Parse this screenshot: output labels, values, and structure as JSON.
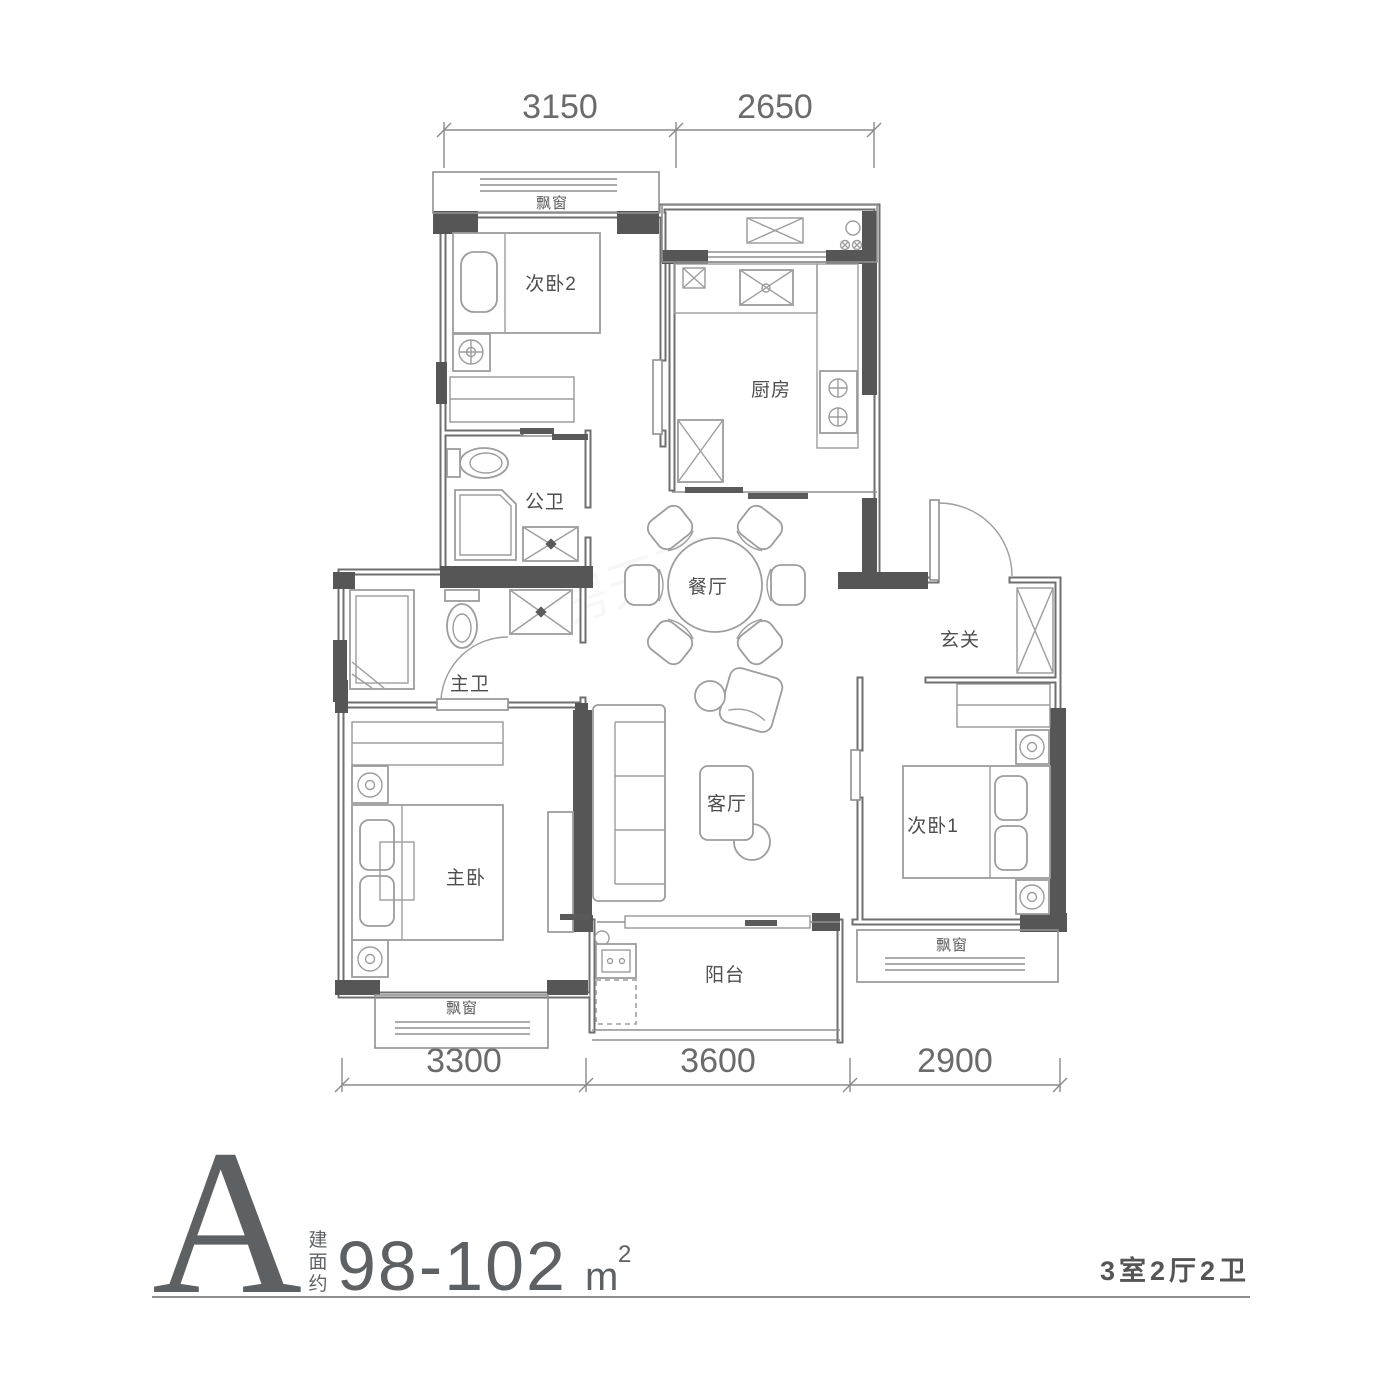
{
  "watermark": "房天下",
  "plan": {
    "bay_window": "飘窗",
    "rooms": {
      "bedroom2": "次卧2",
      "kitchen": "厨房",
      "public_bath": "公卫",
      "master_bath": "主卫",
      "dining": "餐厅",
      "foyer": "玄关",
      "master_bedroom": "主卧",
      "living": "客厅",
      "bedroom1": "次卧1",
      "balcony": "阳台"
    },
    "dimensions": {
      "top": [
        "3150",
        "2650"
      ],
      "bottom": [
        "3300",
        "3600",
        "2900"
      ]
    }
  },
  "legend": {
    "unit_letter": "A",
    "area_prefix": [
      "建",
      "面",
      "约"
    ],
    "area_value": "98-102",
    "area_unit": "m",
    "area_unit_sup": "2",
    "layout_summary": "3室2厅2卫"
  }
}
